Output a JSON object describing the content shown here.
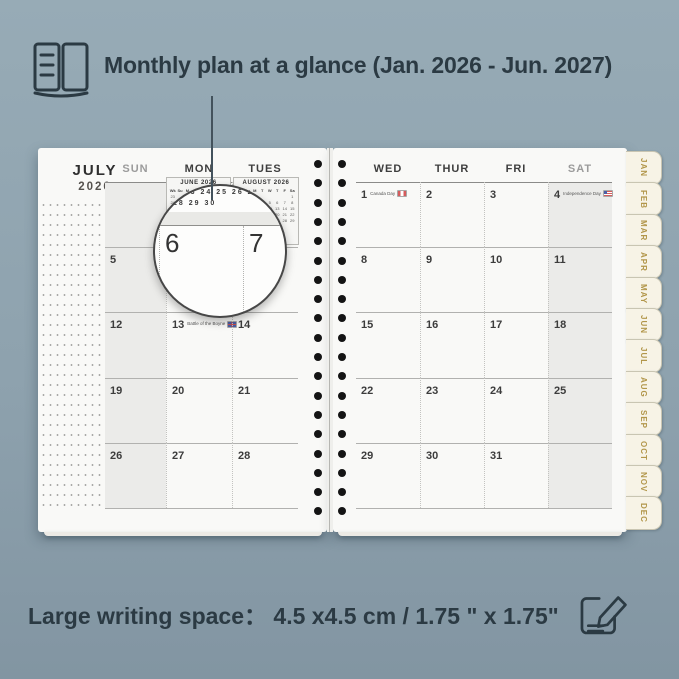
{
  "header": {
    "title": "Monthly plan at a glance (Jan. 2026 - Jun. 2027)",
    "icon": "open-book-icon"
  },
  "footer": {
    "label": "Large writing space：",
    "value": "4.5 x4.5  cm / 1.75 \" x 1.75\"",
    "icon": "pencil-edit-icon"
  },
  "planner": {
    "month": "JULY",
    "year": "2026",
    "left_page": {
      "headers": [
        "SUN",
        "MON",
        "TUES"
      ],
      "weekend_cols": [
        0
      ],
      "rows": [
        [
          "",
          "",
          ""
        ],
        [
          "5",
          "6",
          "7"
        ],
        [
          "12",
          "13",
          "14"
        ],
        [
          "19",
          "20",
          "21"
        ],
        [
          "26",
          "27",
          "28"
        ]
      ],
      "holidays": [
        {
          "date": "13",
          "label": "Battle of the Boyne",
          "flag": "uk"
        }
      ]
    },
    "right_page": {
      "headers": [
        "WED",
        "THUR",
        "FRI",
        "SAT"
      ],
      "weekend_cols": [
        3
      ],
      "rows": [
        [
          "1",
          "2",
          "3",
          "4"
        ],
        [
          "8",
          "9",
          "10",
          "11"
        ],
        [
          "15",
          "16",
          "17",
          "18"
        ],
        [
          "22",
          "23",
          "24",
          "25"
        ],
        [
          "29",
          "30",
          "31",
          ""
        ]
      ],
      "holidays": [
        {
          "date": "1",
          "label": "Canada Day",
          "flag": "ca"
        },
        {
          "date": "4",
          "label": "Independence Day",
          "flag": "us"
        }
      ]
    },
    "mini_calendars": [
      {
        "title": "JUNE 2026",
        "days": [
          "Wk",
          "Su",
          "M",
          "T",
          "W",
          "T",
          "F",
          "Sa"
        ],
        "rows": [
          [
            "23",
            "",
            "1",
            "2",
            "3",
            "4",
            "5",
            "6"
          ],
          [
            "24",
            "7",
            "8",
            "9",
            "10",
            "11",
            "12",
            "13"
          ],
          [
            "25",
            "14",
            "15",
            "16",
            "17",
            "18",
            "19",
            "20"
          ],
          [
            "26",
            "21",
            "22",
            "23",
            "24",
            "25",
            "26",
            "27"
          ],
          [
            "27",
            "28",
            "29",
            "30",
            "",
            "",
            "",
            ""
          ]
        ]
      },
      {
        "title": "AUGUST 2026",
        "days": [
          "Wk",
          "Su",
          "M",
          "T",
          "W",
          "T",
          "F",
          "Sa"
        ],
        "rows": [
          [
            "31",
            "",
            "",
            "",
            "",
            "",
            "",
            "1"
          ],
          [
            "32",
            "2",
            "3",
            "4",
            "5",
            "6",
            "7",
            "8"
          ],
          [
            "33",
            "9",
            "10",
            "11",
            "12",
            "13",
            "14",
            "15"
          ],
          [
            "34",
            "16",
            "17",
            "18",
            "19",
            "20",
            "21",
            "22"
          ],
          [
            "35",
            "23",
            "24",
            "25",
            "26",
            "27",
            "28",
            "29"
          ],
          [
            "36",
            "30",
            "31",
            "",
            "",
            "",
            "",
            ""
          ]
        ]
      }
    ],
    "tabs": [
      "JAN",
      "FEB",
      "MAR",
      "APR",
      "MAY",
      "JUN",
      "JUL",
      "AUG",
      "SEP",
      "OCT",
      "NOV",
      "DEC"
    ],
    "lens": {
      "mini_rows": [
        "22 23 24 25 26 27",
        "28 29 30"
      ],
      "big_dates": [
        "6",
        "7"
      ]
    }
  },
  "colors": {
    "background": "#92a6b2",
    "page": "#f9f9f7",
    "weekend_shade": "#ebebe9",
    "tab_gold": "#b2964a",
    "ink": "#2b3a43",
    "date_dark": "#3c3c3c",
    "date_muted": "#9b9b9b"
  }
}
